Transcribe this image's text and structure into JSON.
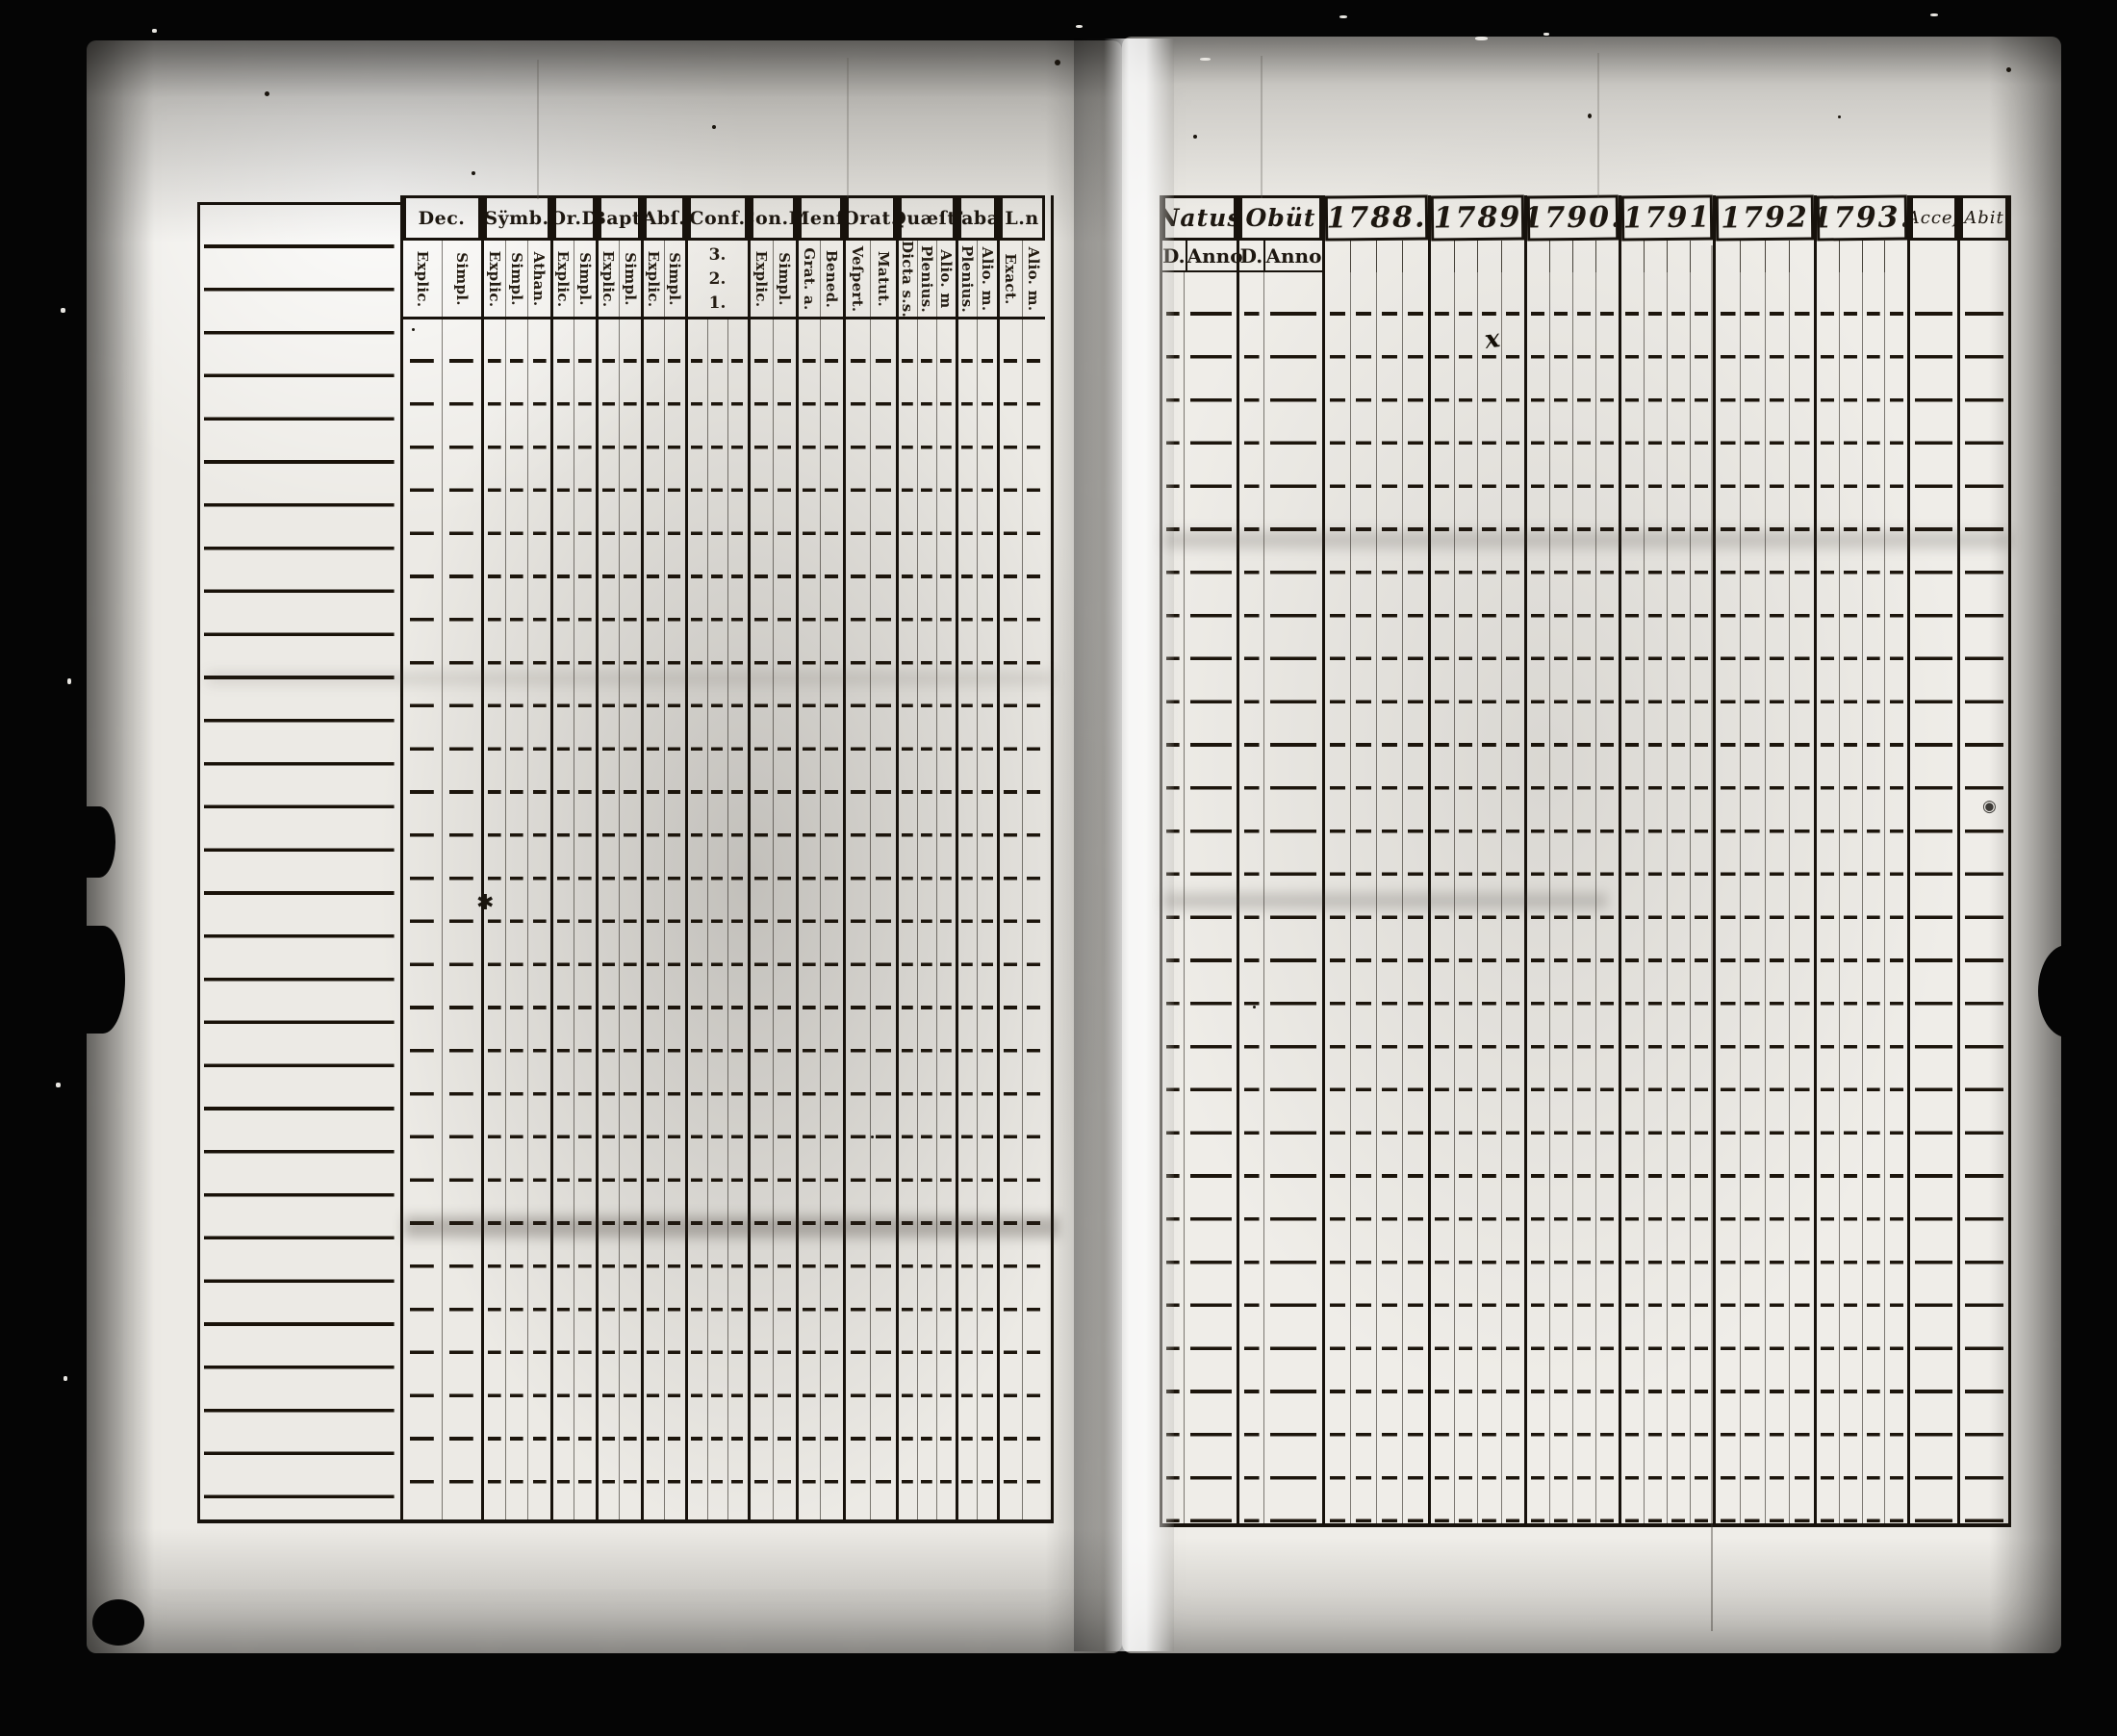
{
  "left_table": {
    "columns": [
      {
        "label": "Dec.",
        "subs": [
          "Explic.",
          "Simpl."
        ]
      },
      {
        "label": "Sÿmb.",
        "subs": [
          "Explic.",
          "Simpl.",
          "Athan."
        ]
      },
      {
        "label": "Or.D",
        "subs": [
          "Explic.",
          "Simpl."
        ]
      },
      {
        "label": "Bapt.",
        "subs": [
          "Explic.",
          "Simpl."
        ]
      },
      {
        "label": "Abſ.",
        "subs": [
          "Explic.",
          "Simpl."
        ]
      },
      {
        "label": "Conf.",
        "subs": [
          "3.",
          "2.",
          "1."
        ]
      },
      {
        "label": "Con.D",
        "subs": [
          "Explic.",
          "Simpl."
        ]
      },
      {
        "label": "Menſ.",
        "subs": [
          "Grat. a.",
          "Bened."
        ]
      },
      {
        "label": "Orat.",
        "subs": [
          "Veſpert.",
          "Matut."
        ]
      },
      {
        "label": "Quæſt.",
        "subs": [
          "Dicta s.s.",
          "Plenius.",
          "Alio. m"
        ]
      },
      {
        "label": "Tabæ",
        "subs": [
          "Plenius.",
          "Alio. m."
        ]
      },
      {
        "label": "L.n",
        "subs": [
          "Exact.",
          "Alio. m."
        ]
      }
    ]
  },
  "right_table": {
    "columns": [
      {
        "label": "Natus",
        "subs": [
          "D.",
          "Anno"
        ]
      },
      {
        "label": "Obüt",
        "subs": [
          "D.",
          "Anno"
        ]
      },
      {
        "label": "1788."
      },
      {
        "label": "1789"
      },
      {
        "label": "1790."
      },
      {
        "label": "1791"
      },
      {
        "label": "1792"
      },
      {
        "label": "1793."
      },
      {
        "label": "Acceſ"
      },
      {
        "label": "Abit"
      }
    ]
  },
  "marks": {
    "asterisk": "✱",
    "cross": "x",
    "ring": "◉"
  }
}
